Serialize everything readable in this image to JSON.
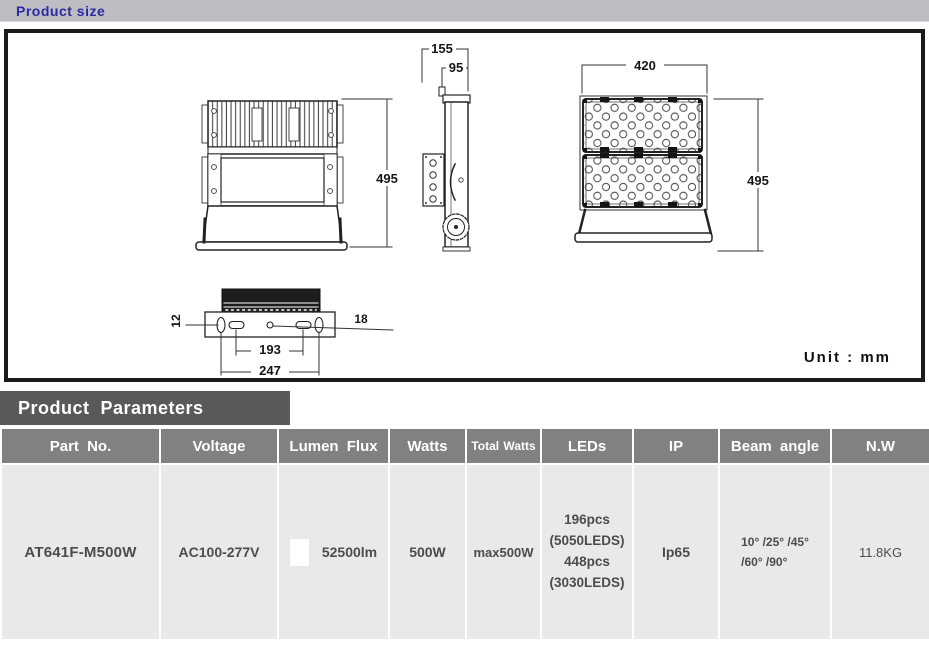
{
  "header": {
    "title": "Product size"
  },
  "drawing": {
    "unit_label": "Unit : mm",
    "dims": {
      "back_height": "495",
      "side_overall_width": "155",
      "side_body_width": "95",
      "front_width": "420",
      "front_height": "495",
      "bracket_thickness": "12",
      "bracket_hole": "18",
      "slot_spacing": "193",
      "hole_spacing": "247"
    }
  },
  "parameters": {
    "title": "Product  Parameters",
    "columns": [
      "Part No.",
      "Voltage",
      "Lumen Flux",
      "Watts",
      "Total Watts",
      "LEDs",
      "IP",
      "Beam angle",
      "N.W"
    ],
    "row": {
      "part_no": "AT641F-M500W",
      "voltage": "AC100-277V",
      "lumen_flux": "52500lm",
      "watts": "500W",
      "total_watts": "max500W",
      "leds": [
        "196pcs",
        "(5050LEDS)",
        "448pcs",
        "(3030LEDS)"
      ],
      "ip": "Ip65",
      "beam_angle": [
        "10° /25° /45°",
        "/60° /90°"
      ],
      "net_weight": "11.8KG"
    }
  },
  "colors": {
    "title_blue": "#2A2AA4",
    "bar_silver": "#BDBDC2",
    "panel_border": "#1B1B1B",
    "params_bar_gray": "#595959",
    "table_header_gray": "#818181",
    "table_row_gray": "#E9E9E9",
    "body_text_gray": "#4C4C4C"
  }
}
